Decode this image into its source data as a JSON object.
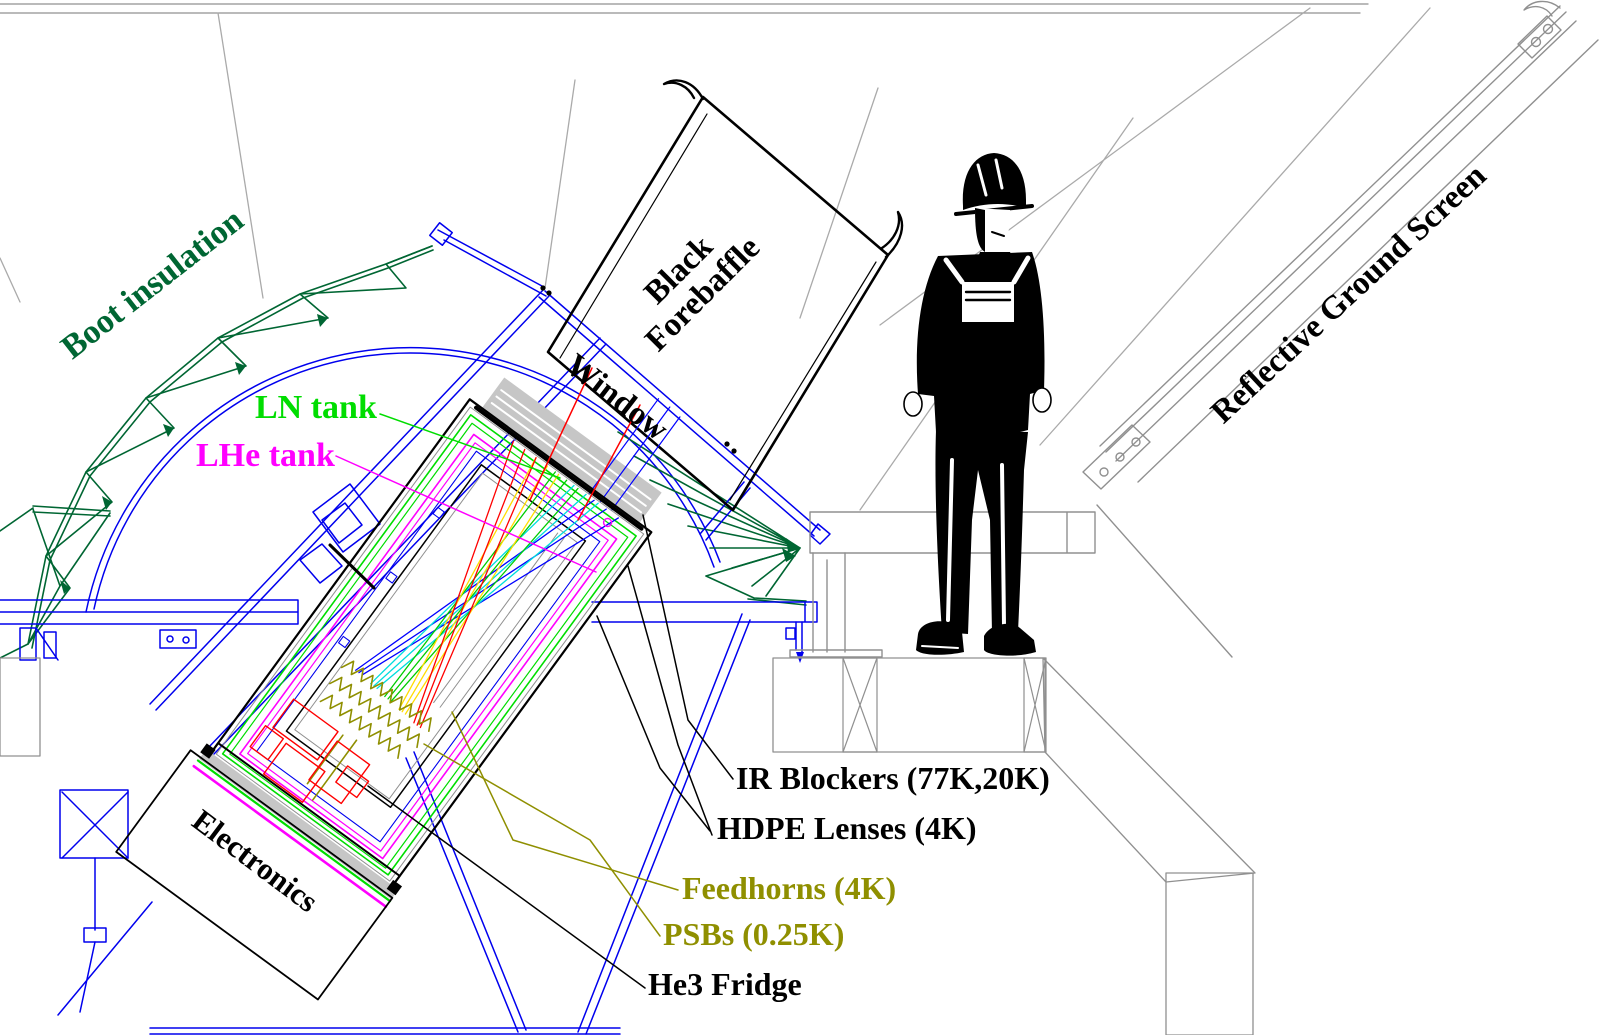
{
  "title": "Telescope cryostat cross-section diagram",
  "labels": {
    "boot_insulation": {
      "text": "Boot insulation",
      "color": "#006633"
    },
    "ln_tank": {
      "text": "LN tank",
      "color": "#00dd00"
    },
    "lhe_tank": {
      "text": "LHe tank",
      "color": "#ff00ff"
    },
    "forebaffle_line1": {
      "text": "Black",
      "color": "#000000"
    },
    "forebaffle_line2": {
      "text": "Forebaffle",
      "color": "#000000"
    },
    "window": {
      "text": "Window",
      "color": "#000000"
    },
    "ground_screen": {
      "text": "Reflective Ground Screen",
      "color": "#000000"
    },
    "electronics": {
      "text": "Electronics",
      "color": "#000000"
    },
    "ir_blockers": {
      "text": "IR Blockers (77K,20K)",
      "color": "#000000"
    },
    "hdpe_lenses": {
      "text": "HDPE Lenses (4K)",
      "color": "#000000"
    },
    "feedhorns": {
      "text": "Feedhorns (4K)",
      "color": "#8f8f00"
    },
    "psbs": {
      "text": "PSBs (0.25K)",
      "color": "#8f8f00"
    },
    "he3_fridge": {
      "text": "He3 Fridge",
      "color": "#000000"
    }
  },
  "colors": {
    "line_black": "#000000",
    "frame_blue": "#0000ee",
    "ln_green": "#00dd00",
    "lhe_magenta": "#ff00ff",
    "boot_green": "#006633",
    "olive": "#8f8f00",
    "structure_gray": "#909090",
    "window_gray": "#c6c6c6",
    "ray_red": "#ff0000",
    "ray_yellow": "#ffdd00",
    "ray_green": "#00cc00",
    "ray_cyan": "#00dddd",
    "ray_blue": "#0000ff"
  }
}
